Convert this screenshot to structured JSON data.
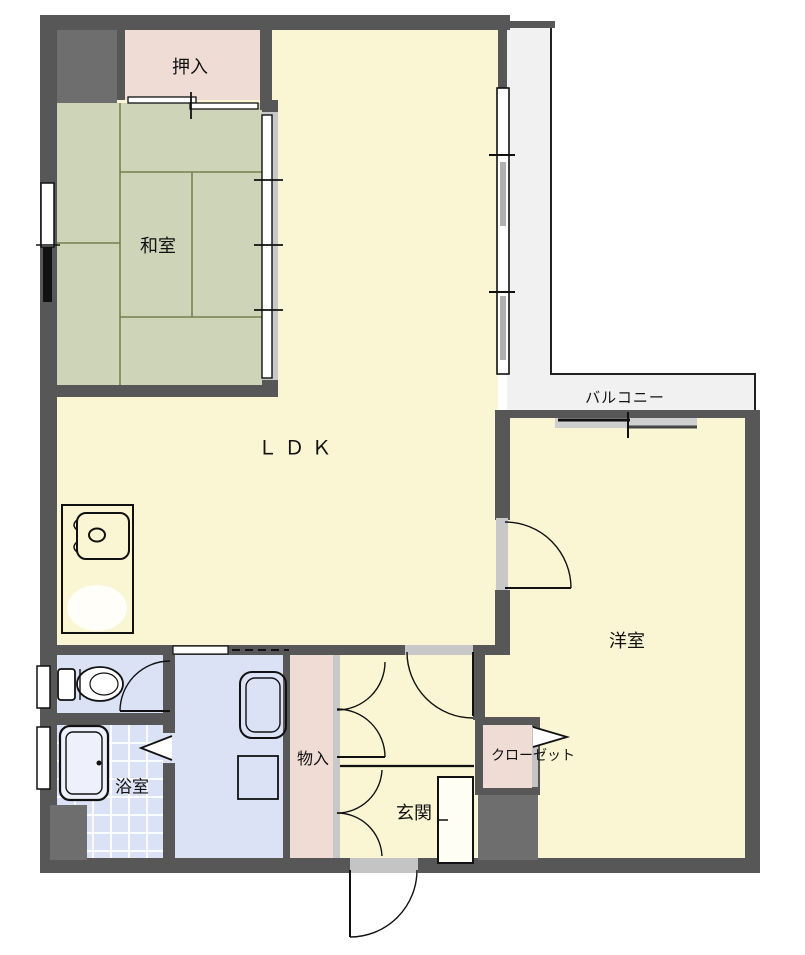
{
  "floorplan": {
    "type": "apartment-floor-plan",
    "rooms": {
      "oshiire": {
        "label": "押入"
      },
      "washitsu": {
        "label": "和室"
      },
      "ldk": {
        "label": "ＬＤＫ"
      },
      "balcony": {
        "label": "バルコニー"
      },
      "yoshitsu": {
        "label": "洋室"
      },
      "bathroom": {
        "label": "浴室"
      },
      "storage": {
        "label": "物入"
      },
      "genkan": {
        "label": "玄関"
      },
      "closet": {
        "label": "クローゼット"
      }
    },
    "colors": {
      "wall": "#575757",
      "floor_yellow": "#faf6d3",
      "tatami_green": "#ced4b8",
      "tatami_line": "#76804f",
      "storage_pink": "#efddd5",
      "wet_blue": "#dce2f6",
      "balcony_gray": "#f1f1f1",
      "opening_gray": "#c8c8c8",
      "line_black": "#111111"
    }
  }
}
